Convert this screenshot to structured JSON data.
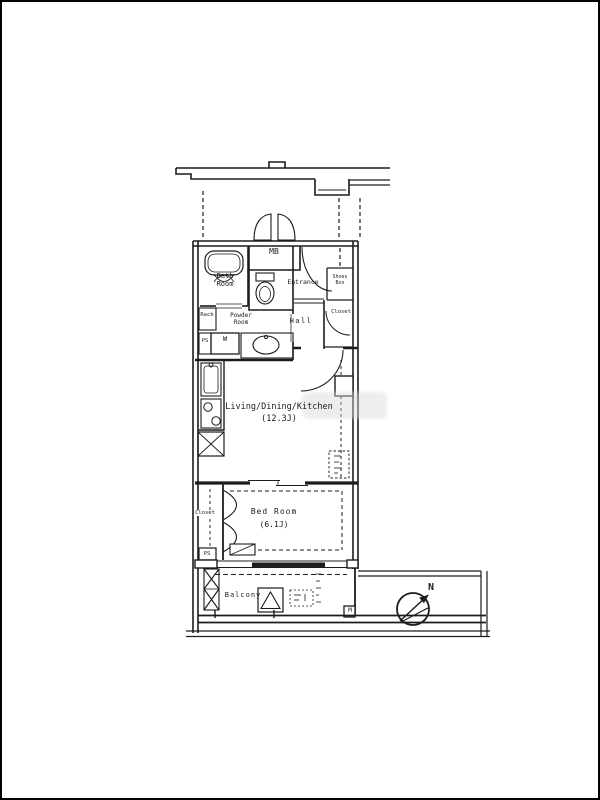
{
  "floorplan": {
    "labels": {
      "mb": "MB",
      "bath": "Bath\nRoom",
      "entrance": "Entrance",
      "shoes_box": "Shoes\nBox",
      "hall": "Hall",
      "hall_closet": "Closet",
      "powder_room": "Powder\nRoom",
      "rack": "Rack",
      "ps_upper": "PS",
      "washer": "W",
      "ldk_name": "Living/Dining/Kitchen",
      "ldk_size": "(12.3J)",
      "bed_name": "Bed Room",
      "bed_size": "(6.1J)",
      "bed_closet": "Closet",
      "ps_lower": "PS",
      "balcony": "Balcony",
      "meter": "M",
      "compass_north": "N"
    },
    "colors": {
      "line": "#1c1c1c",
      "background": "#ffffff"
    }
  }
}
